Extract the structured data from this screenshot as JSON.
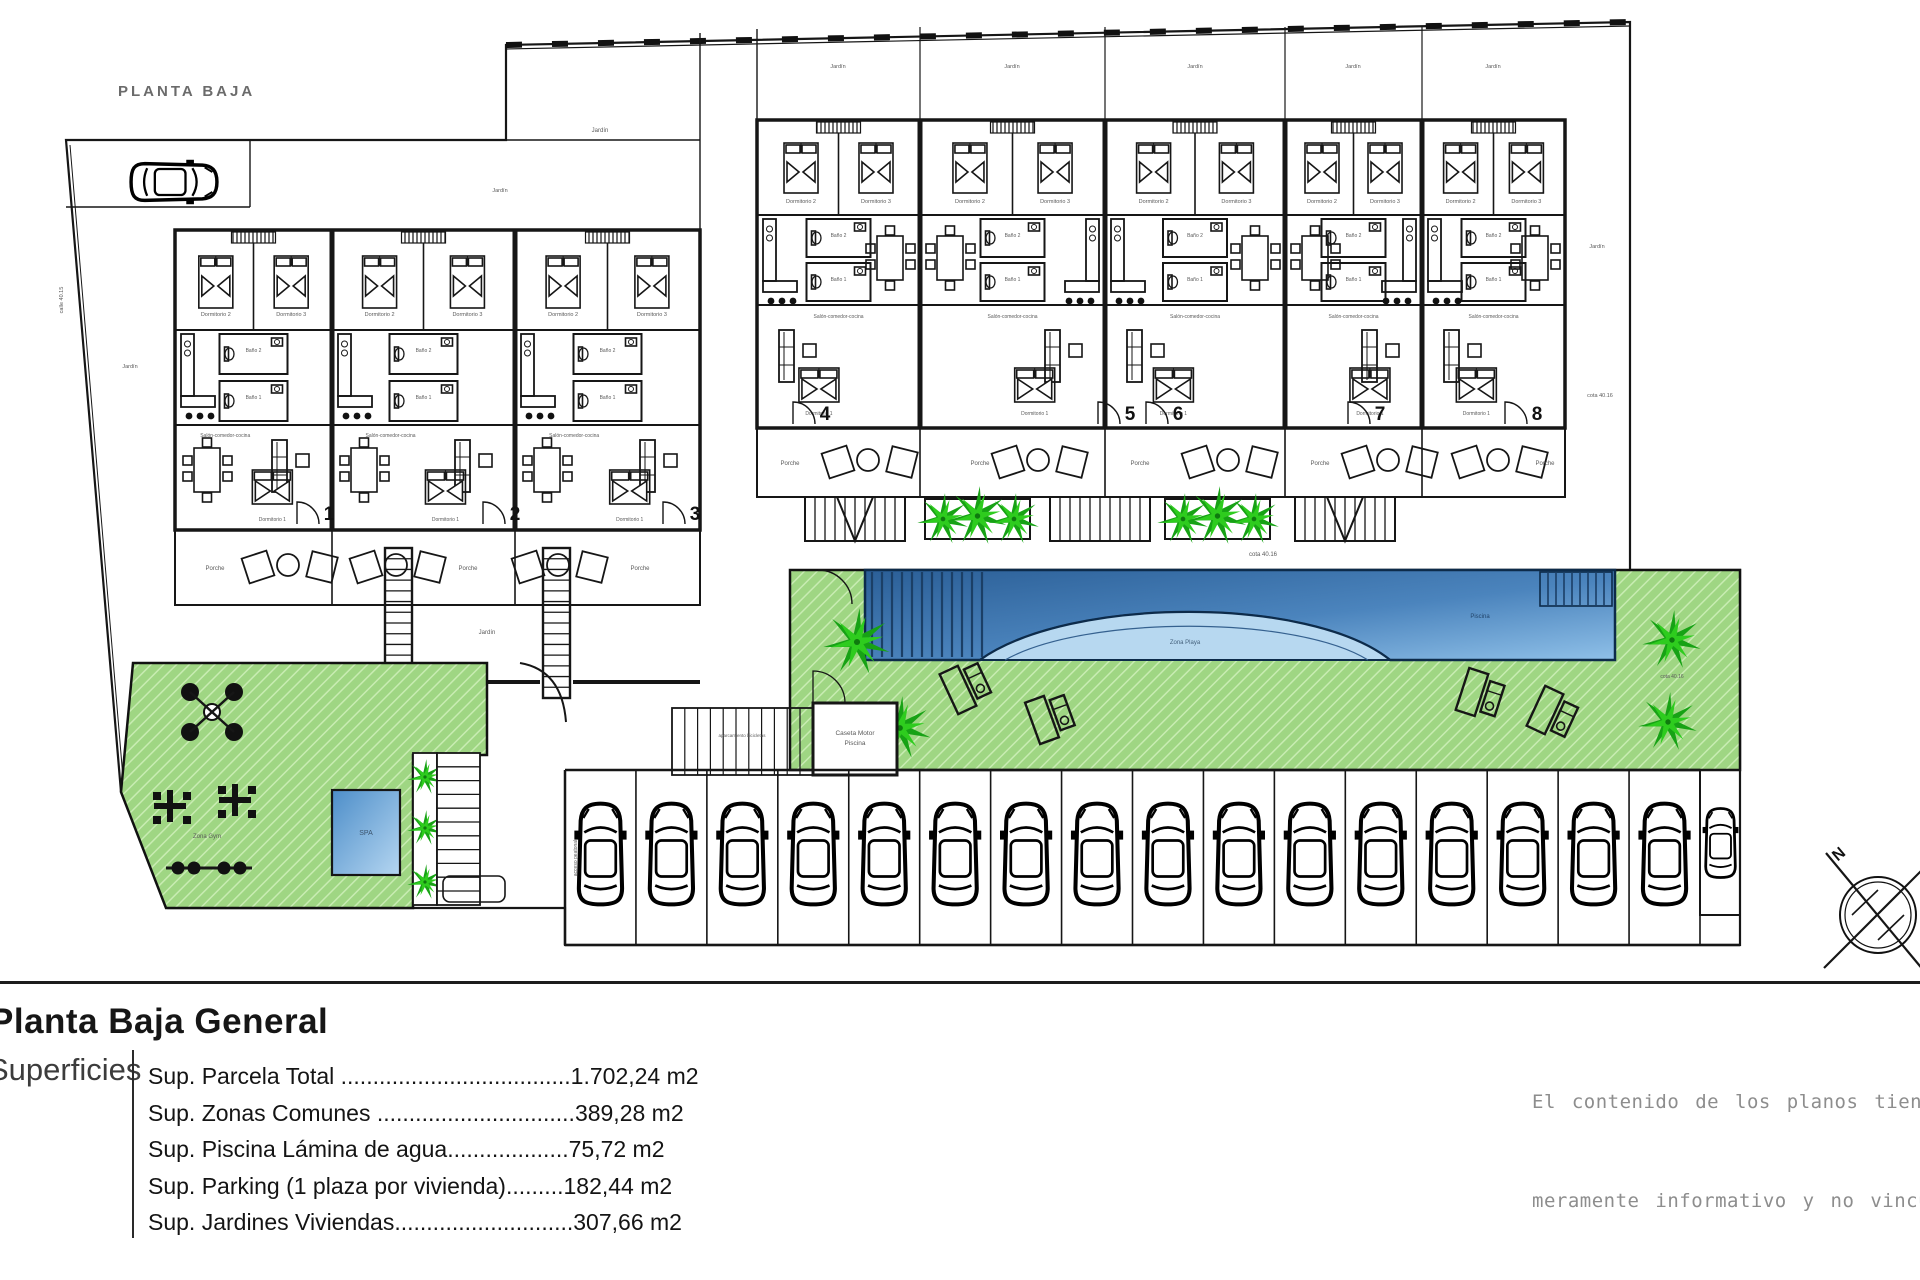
{
  "plan": {
    "title": "PLANTA BAJA",
    "compass_n": "N"
  },
  "units": {
    "left": [
      "1",
      "2",
      "3"
    ],
    "right": [
      "4",
      "5",
      "6",
      "7",
      "8"
    ]
  },
  "rooms": {
    "dorm1": "Dormitorio 1",
    "dorm2": "Dormitorio 2",
    "dorm3": "Dormitorio 3",
    "bano1": "Baño 1",
    "bano2": "Baño 2",
    "salon": "Salón-comedor-cocina",
    "porche": "Porche",
    "jardin": "Jardín"
  },
  "site_labels": {
    "piscina": "Piscina",
    "zona_playa": "Zona Playa",
    "spa": "SPA",
    "zona_gym": "Zona Gym",
    "caseta_line1": "Caseta Motor",
    "caseta_line2": "Piscina",
    "bike": "aparcamiento bicicletas",
    "cota_a": "cota 40.15",
    "cota_b": "cota 40.16",
    "calle": "calle 40.15",
    "acceso": "acceso peatonal"
  },
  "parking": {
    "stalls": 16
  },
  "legend": {
    "title": "Planta Baja General",
    "section_label": "Superficies",
    "rows": [
      "Sup. Parcela Total ....................................1.702,24 m2",
      "Sup. Zonas Comunes ...............................389,28 m2",
      "Sup. Piscina Lámina de agua...................75,72 m2",
      "Sup. Parking (1 plaza por vivienda).........182,44 m2",
      "Sup. Jardines Viviendas............................307,66 m2"
    ]
  },
  "disclaimer": {
    "line1": "El contenido de los planos tiene valor",
    "line2": "meramente informativo y no vinculante"
  },
  "colors": {
    "grass": "#9fd683",
    "palm": "#1daa10",
    "pool_dark": "#33689f",
    "pool_light": "#8fc0e8",
    "beach": "#b7d8f0",
    "line": "#161616"
  }
}
